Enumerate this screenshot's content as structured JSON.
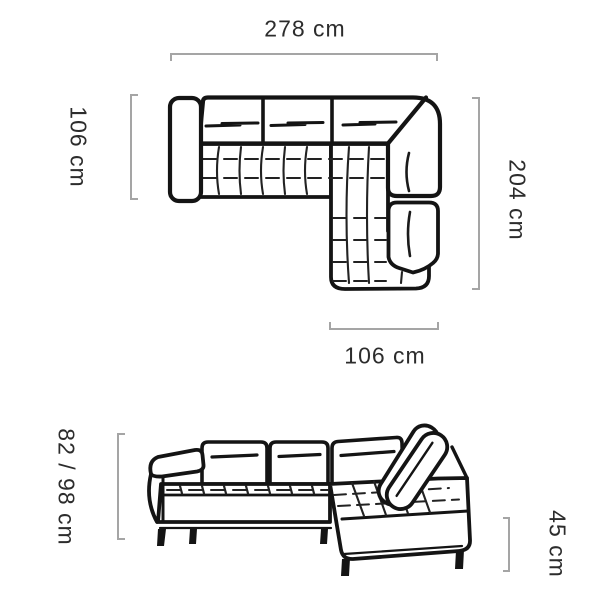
{
  "colors": {
    "line": "#141414",
    "bracket": "#a5a5a5",
    "text": "#2c2c2c",
    "background": "#ffffff"
  },
  "top_view": {
    "dimensions": {
      "total_width": "278 cm",
      "left_depth": "106 cm",
      "right_length": "204 cm",
      "chaise_width": "106 cm"
    }
  },
  "front_view": {
    "dimensions": {
      "backrest_height": "82 / 98 cm",
      "seat_height": "45 cm"
    }
  }
}
